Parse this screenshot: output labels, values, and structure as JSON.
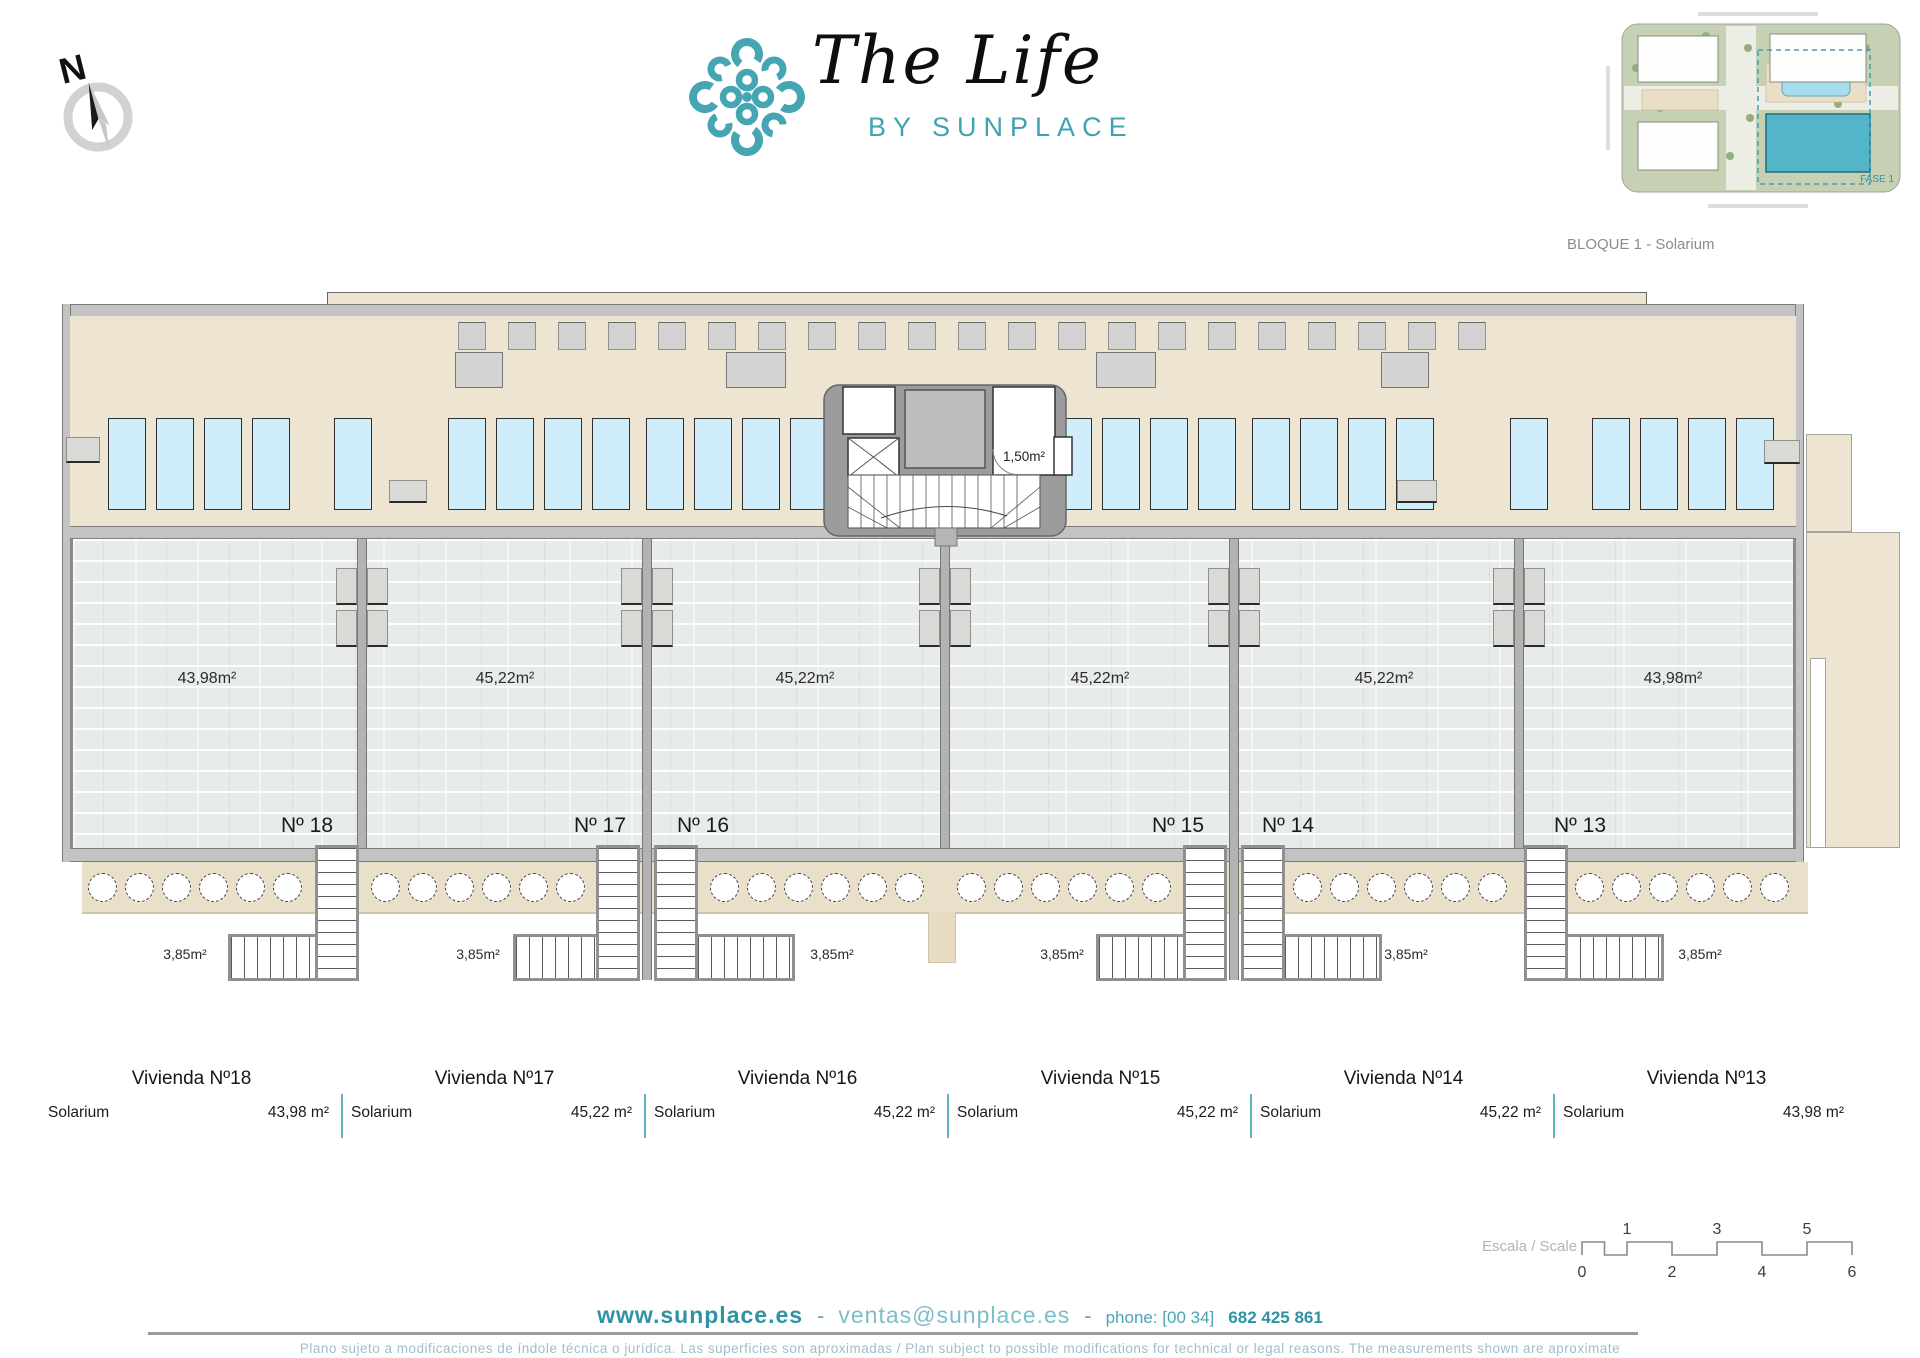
{
  "brand": {
    "title": "The Life",
    "subtitle": "BY SUNPLACE"
  },
  "compass": {
    "label": "N"
  },
  "site_plan": {
    "caption": "BLOQUE 1 - Solarium",
    "fase_label": "FASE 1"
  },
  "plan": {
    "core_label": "1,50m²",
    "units": [
      {
        "number": "Nº 18",
        "area": "43,98m²",
        "stair_area": "3,85m²"
      },
      {
        "number": "Nº 17",
        "area": "45,22m²",
        "stair_area": "3,85m²"
      },
      {
        "number": "Nº 16",
        "area": "45,22m²",
        "stair_area": "3,85m²"
      },
      {
        "number": "Nº 15",
        "area": "45,22m²",
        "stair_area": "3,85m²"
      },
      {
        "number": "Nº 14",
        "area": "45,22m²",
        "stair_area": "3,85m²"
      },
      {
        "number": "Nº 13",
        "area": "43,98m²",
        "stair_area": "3,85m²"
      }
    ]
  },
  "legend": {
    "columns": [
      {
        "title": "Vivienda Nº18",
        "label": "Solarium",
        "value": "43,98 m²"
      },
      {
        "title": "Vivienda Nº17",
        "label": "Solarium",
        "value": "45,22 m²"
      },
      {
        "title": "Vivienda Nº16",
        "label": "Solarium",
        "value": "45,22 m²"
      },
      {
        "title": "Vivienda Nº15",
        "label": "Solarium",
        "value": "45,22 m²"
      },
      {
        "title": "Vivienda Nº14",
        "label": "Solarium",
        "value": "45,22 m²"
      },
      {
        "title": "Vivienda Nº13",
        "label": "Solarium",
        "value": "43,98 m²"
      }
    ]
  },
  "scale_bar": {
    "label": "Escala / Scale",
    "top_numbers": [
      "1",
      "3",
      "5"
    ],
    "bottom_numbers": [
      "0",
      "2",
      "4",
      "6"
    ]
  },
  "footer": {
    "website": "www.sunplace.es",
    "separator1": "-",
    "email": "ventas@sunplace.es",
    "separator2": "-",
    "phone_label": "phone: [00 34]",
    "phone_number": "682 425 861",
    "disclaimer": "Plano sujeto a modificaciones de índole técnica o jurídica. Las superficies son aproximadas / Plan subject to possible modifications for technical or legal reasons. The measurements shown are aproximate"
  },
  "colors": {
    "brand_teal": "#46A5B2",
    "beige": "#EDE5D2",
    "walkway_beige": "#EADFC9",
    "tile_gray": "#E7EBEA",
    "wall_gray": "#9C9C9C",
    "lounger_blue": "#CFEDFB",
    "legend_divider": "#5BB4C0",
    "highlight_building": "#54B4C8"
  }
}
